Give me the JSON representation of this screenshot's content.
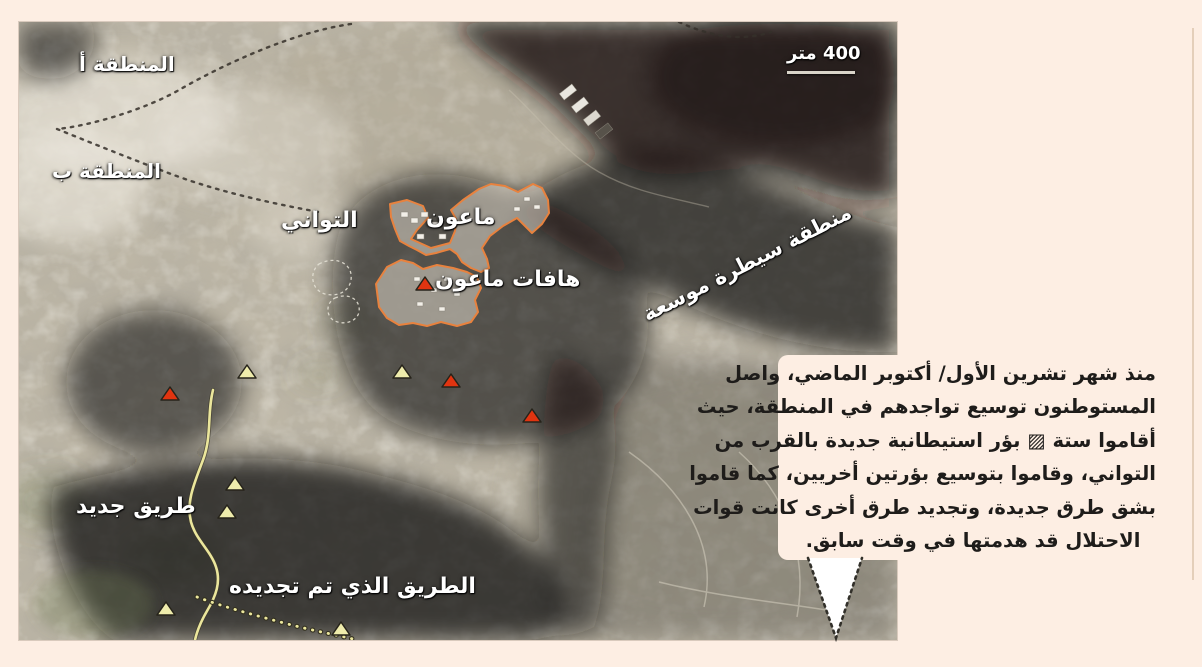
{
  "scalebar": {
    "label": "400 متر"
  },
  "map_labels": {
    "area_a": "المنطقة أ",
    "area_b": "المنطقة ب",
    "tuwani": "التواني",
    "maon": "ماعون",
    "havat_maon": "هافات ماعون",
    "expanded_control_zone": "منطقة سيطرة موسعة",
    "new_road": "طريق جديد",
    "renewed_road": "الطريق الذي تم تجديده"
  },
  "callout": {
    "lines": [
      "منذ شهر تشرين الأول/ أكتوبر الماضي، واصل",
      "المستوطنون توسيع تواجدهم في المنطقة، حيث",
      "أقاموا ستة ▨ بؤر استيطانية جديدة بالقرب من",
      "التواني، وقاموا بتوسيع بؤرتين أخريين، كما قاموا",
      "بشق طرق جديدة، وتجديد طرق أخرى كانت قوات",
      "الاحتلال قد هدمتها في وقت سابق."
    ]
  },
  "markers": {
    "red_color": "#e13410",
    "yellow_color": "#efecac",
    "outline_color": "#26231a",
    "red_outposts": [
      {
        "x": 406,
        "y": 263
      },
      {
        "x": 432,
        "y": 360
      },
      {
        "x": 513,
        "y": 395
      },
      {
        "x": 151,
        "y": 373
      }
    ],
    "yellow_points": [
      {
        "x": 383,
        "y": 351
      },
      {
        "x": 228,
        "y": 351
      },
      {
        "x": 216,
        "y": 463
      },
      {
        "x": 208,
        "y": 491
      },
      {
        "x": 147,
        "y": 588
      },
      {
        "x": 322,
        "y": 608
      }
    ]
  },
  "colors": {
    "page_background": "#fdeee3",
    "settlement_outline": "#e8823e",
    "road_yellow": "#ece79e",
    "label_white": "#ffffff"
  }
}
